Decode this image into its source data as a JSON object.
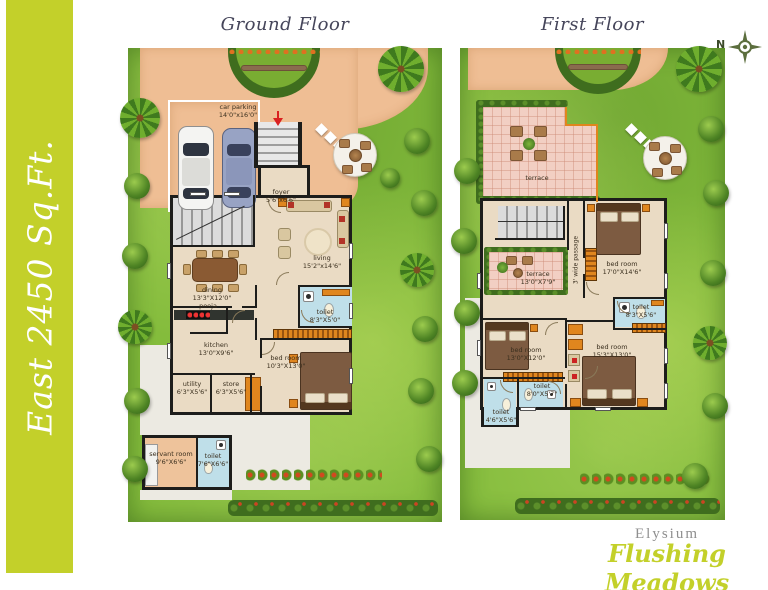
{
  "sidebar": {
    "text": "East 2450 Sq.Ft."
  },
  "floors": {
    "ground": "Ground Floor",
    "first": "First Floor"
  },
  "compass": {
    "north": "N"
  },
  "gf": {
    "car_parking": {
      "label": "car parking",
      "dims": "14'0\"x16'0\""
    },
    "foyer": {
      "label": "foyer",
      "dims": "5'6\"x6'6\""
    },
    "living": {
      "label": "living",
      "dims": "15'2\"x14'6\""
    },
    "dining": {
      "label": "dining",
      "dims": "13'3\"X12'0\""
    },
    "pooja": {
      "label": "pooja"
    },
    "kitchen": {
      "label": "kitchen",
      "dims": "13'0\"X9'6\""
    },
    "utility": {
      "label": "utility",
      "dims": "6'3\"X5'6\""
    },
    "store": {
      "label": "store",
      "dims": "6'3\"X5'6\""
    },
    "toilet": {
      "label": "toilet",
      "dims": "8'3\"X5'0\""
    },
    "bed_room": {
      "label": "bed room",
      "dims": "10'3\"X13'0\""
    },
    "servant_room": {
      "label": "servant room",
      "dims": "9'6\"X6'6\""
    },
    "servant_toilet": {
      "label": "toilet",
      "dims": "7'6\"X6'6\""
    }
  },
  "ff": {
    "terrace_large": {
      "label": "terrace"
    },
    "terrace_small": {
      "label": "terrace",
      "dims": "13'0\"X7'9\""
    },
    "passage": {
      "label": "3' wide passage"
    },
    "bed_room_1": {
      "label": "bed room",
      "dims": "17'0\"X14'6\""
    },
    "toilet_1": {
      "label": "toilet",
      "dims": "8'3\"X5'6\""
    },
    "bed_room_2": {
      "label": "bed room",
      "dims": "13'0\"X12'0\""
    },
    "toilet_2": {
      "label": "toilet",
      "dims": "8'0\"X5'7\""
    },
    "toilet_3": {
      "label": "toilet",
      "dims": "4'6\"X5'6\""
    },
    "bed_room_3": {
      "label": "bed room",
      "dims": "15'3\"X13'0\""
    }
  },
  "branding": {
    "name": "Elysium",
    "project": "Flushing Meadows",
    "tagline": "signature villas"
  },
  "colors": {
    "brand": "#c3d02a",
    "lawn": "#84bc3c",
    "peach": "#efbe94",
    "pink": "#f2cfc3",
    "beige": "#eadbc4",
    "orange": "#e0861e",
    "tblue": "#bfdfe9",
    "wall": "#1d1d1b",
    "hedge": "#3f6d1e"
  }
}
